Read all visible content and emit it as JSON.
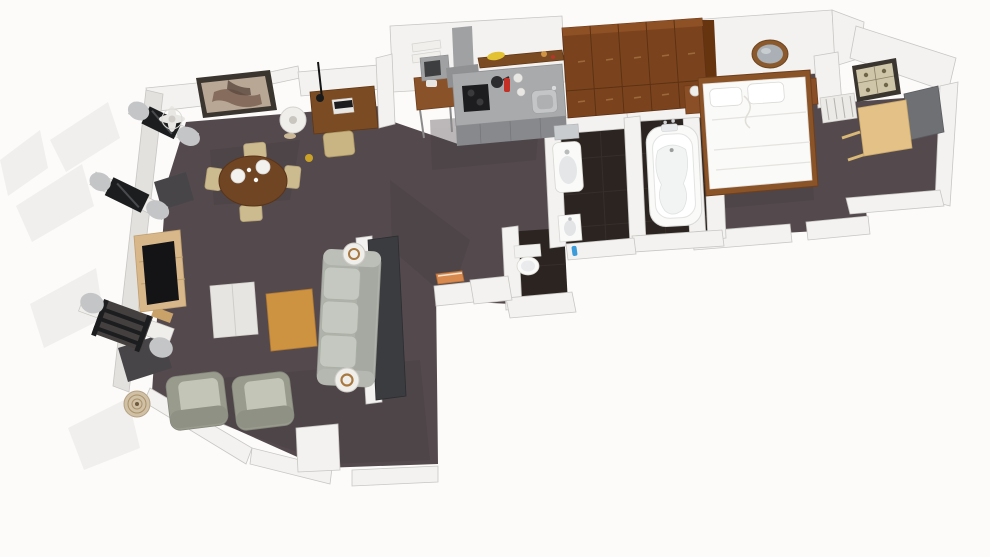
{
  "scene": {
    "type": "3d-floor-plan-render",
    "description": "Top-down 3D rendering of a one-bedroom apartment",
    "width": 990,
    "height": 557
  },
  "palette": {
    "bg": "#FCFBFA",
    "exterior": "#F0EFED",
    "carpet": "#544A4E",
    "carpetShade": "#453C40",
    "tile": "#2B2421",
    "tileLine": "#3E352F",
    "wallTop": "#F3F2F0",
    "wallSide": "#E2E1DE",
    "wallEdge": "#C7C6C3",
    "dividerPanel": "#3B3C3F",
    "diningWood": "#6F4524",
    "deskBrown": "#7B4B23",
    "standBrown": "#8A5228",
    "wardrobe": "#7B431D",
    "wardrobeTop": "#8E5126",
    "wardrobeSide": "#66350F",
    "wardrobeLine": "#5C3212",
    "nightstand": "#8A4F26",
    "bedFrame": "#8A5328",
    "white": "#FAFAF8",
    "offWhite": "#EFEEEA",
    "counterTop": "#A8AAAC",
    "counterFront": "#87898C",
    "applianceGray": "#9FA1A3",
    "cooktopBlack": "#1D1D1F",
    "tvBlack": "#141417",
    "frameBlack": "#1C1D1F",
    "sofa": "#AFB2AB",
    "sofaCushion": "#C5C8C0",
    "armchair": "#999B8D",
    "armchairSeat": "#C3C5B7",
    "ottoman": "#E7E5E1",
    "tvStandWood": "#D8B88B",
    "coffeeWood": "#CE9340",
    "deskLight": "#E4C287",
    "curtain": "#C4C5C7",
    "glassGray": "#6E7073",
    "mirrorGlass": "#AAB0B5",
    "bronze": "#8A5A2E",
    "artBeige": "#CFC5A8",
    "artFrame": "#3A352F",
    "orange": "#D8894E",
    "banana": "#E2C133",
    "red": "#C23026",
    "blue": "#3C9BD8",
    "basket": "#CFC0A6",
    "brassRing": "#A87840",
    "matDark": "#474548"
  },
  "rooms": [
    {
      "id": "living-room",
      "furniture": [
        "tv-stand",
        "television",
        "sofa",
        "floor-lamp-north",
        "floor-lamp-south",
        "coffee-table",
        "ottoman",
        "armchair-1",
        "armchair-2",
        "wicker-basket",
        "room-divider-panel",
        "window-top",
        "window-middle",
        "window-bottom",
        "curtains",
        "floor-mats"
      ]
    },
    {
      "id": "dining-area",
      "furniture": [
        "dining-table",
        "dining-chairs",
        "dinner-plates",
        "wall-painting",
        "ceiling-fan",
        "floor-lamp"
      ]
    },
    {
      "id": "work-nook",
      "furniture": [
        "writing-desk",
        "desk-chair",
        "laptop",
        "desk-lamp"
      ]
    },
    {
      "id": "kitchen",
      "furniture": [
        "kitchen-counter",
        "sink",
        "cooktop",
        "range-hood",
        "cooking-pot",
        "fire-extinguisher",
        "jars",
        "shelf-with-bananas",
        "towel-shelf",
        "microwave",
        "microwave-stand",
        "wardrobe-cabinet"
      ]
    },
    {
      "id": "hallway",
      "furniture": [
        "orange-wall-shelf"
      ]
    },
    {
      "id": "bathroom",
      "furniture": [
        "washbasin",
        "wall-mirror-small",
        "bathtub",
        "bath-faucet"
      ]
    },
    {
      "id": "wc",
      "furniture": [
        "toilet",
        "hand-sink",
        "toilet-brush"
      ]
    },
    {
      "id": "bedroom",
      "furniture": [
        "double-bed",
        "pillows",
        "nightstand-left",
        "nightstand-right",
        "table-lamps",
        "round-wall-mirror",
        "radiator",
        "wall-art",
        "wall-panel",
        "bedroom-desk"
      ]
    }
  ]
}
